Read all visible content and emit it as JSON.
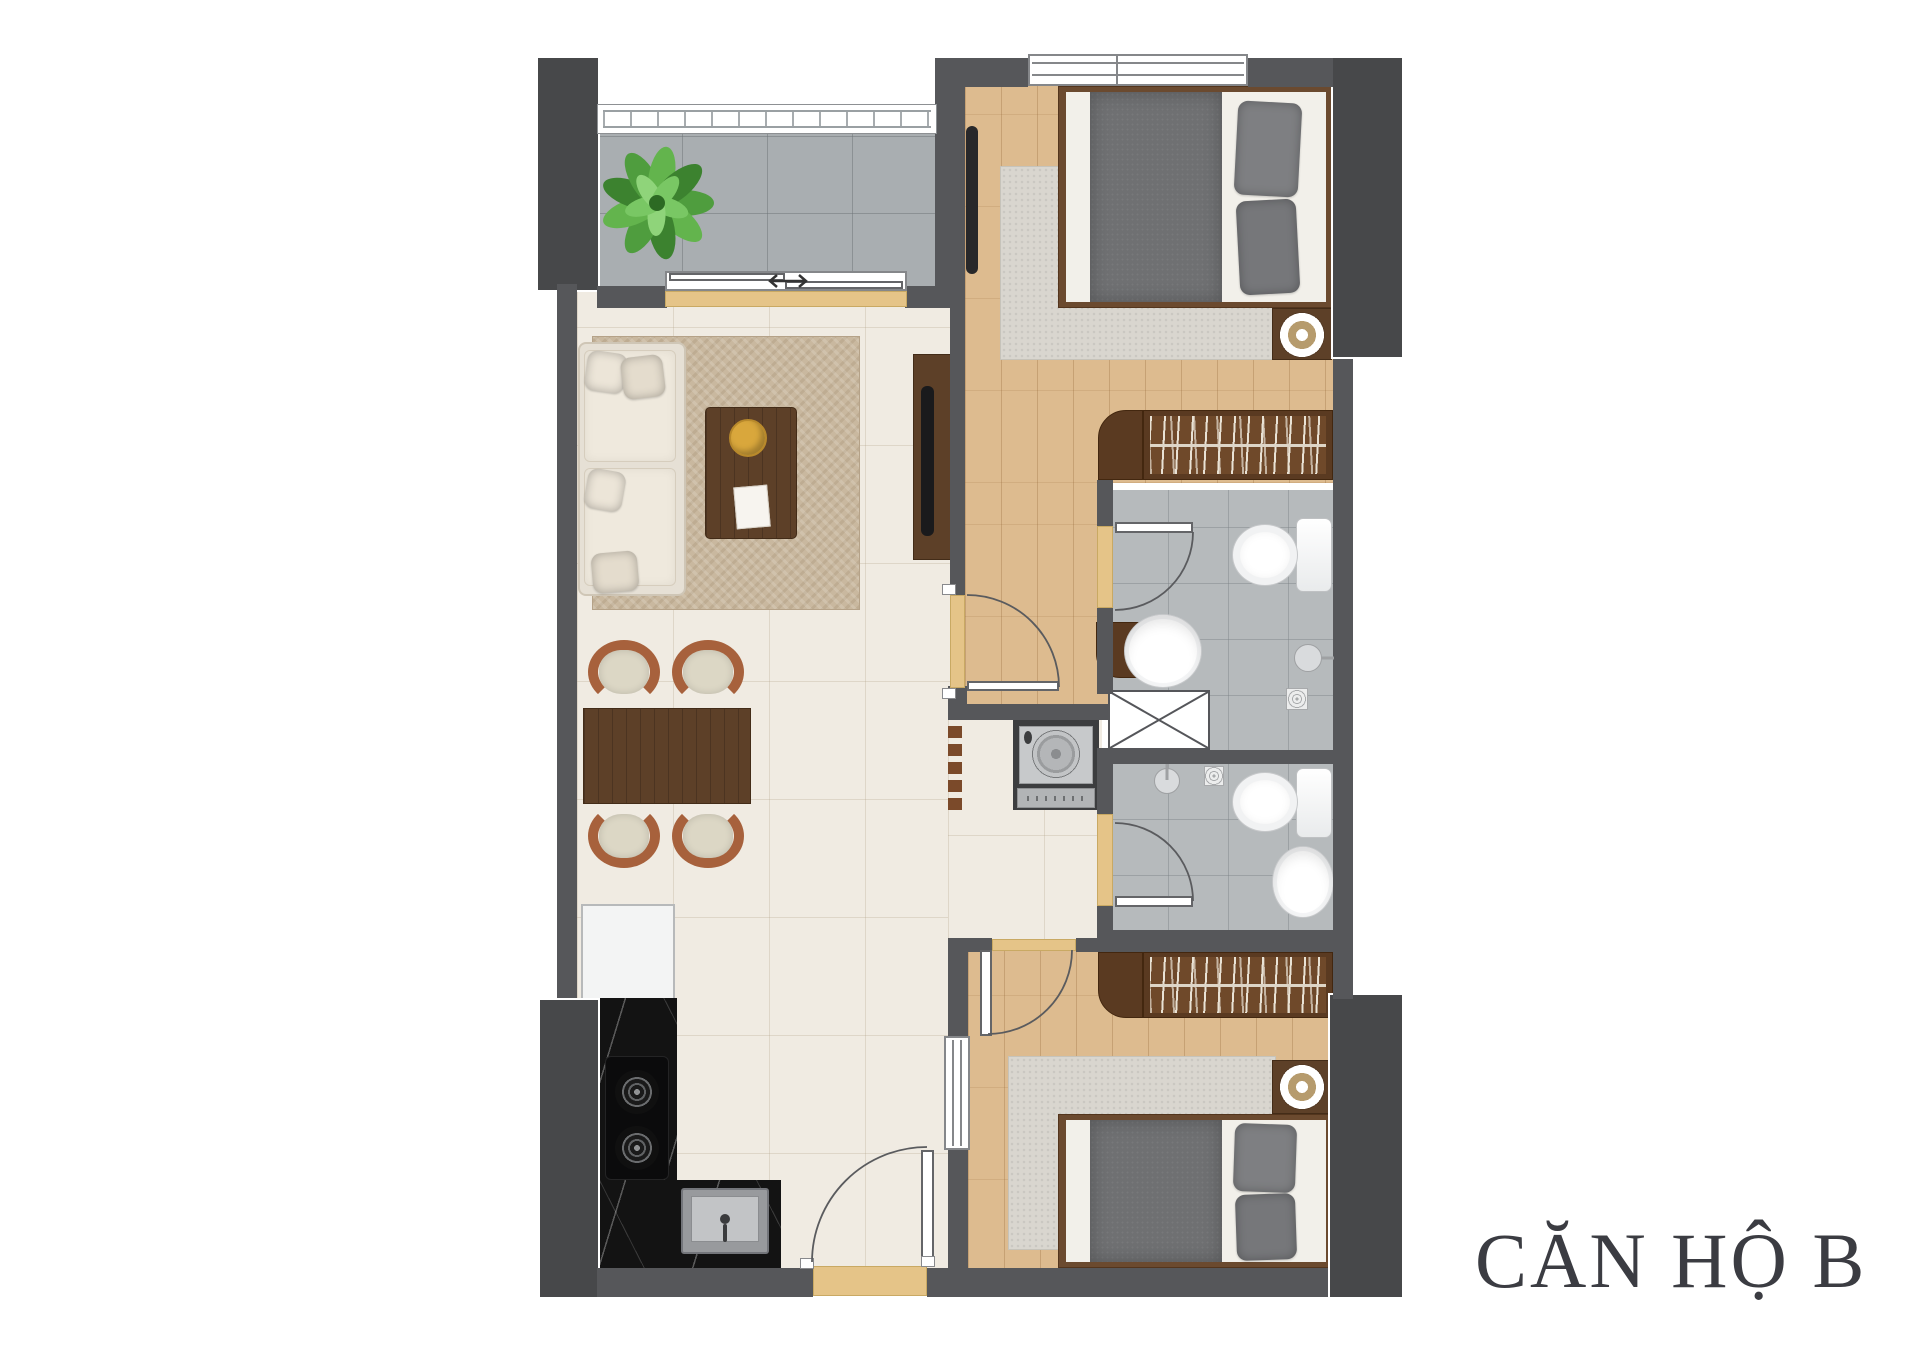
{
  "title": {
    "label": "CĂN HỘ B",
    "color": "#3b3c42"
  },
  "palette": {
    "background": "#ffffff",
    "wall": "#56575a",
    "pillar": "#47484a",
    "wood_floor": "#ddbb8f",
    "cream_floor": "#f0ebe2",
    "balcony_tile": "#a9aeb1",
    "bathroom_tile": "#b6babc",
    "threshold_accent": "#e5c488",
    "furniture_wood": "#5d4028",
    "wardrobe_wood": "#5a3a21",
    "sofa": "#e6e0d5",
    "living_rug": "#c9b89f",
    "bedroom_rug": "#d9d6cf",
    "bed_blanket": "#6f7072",
    "kitchen_counter": "#131313",
    "fixture_white": "#ffffff",
    "plant_green": "#55a243",
    "chair_frame": "#a7613c",
    "door_line": "#5a5b5e"
  },
  "plan": {
    "type": "apartment-floor-plan",
    "rooms": [
      {
        "id": "balcony",
        "items": [
          "potted-plant",
          "tile-floor",
          "railing",
          "sliding-door",
          "slide-arrow"
        ]
      },
      {
        "id": "living-room",
        "items": [
          "l-shaped-sofa",
          "throw-pillows",
          "coffee-table",
          "round-tray",
          "book",
          "area-rug",
          "tv-console",
          "tv"
        ]
      },
      {
        "id": "dining-area",
        "items": [
          "dining-table",
          "chair",
          "chair",
          "chair",
          "chair",
          "decor-partition"
        ]
      },
      {
        "id": "kitchen",
        "items": [
          "refrigerator",
          "marble-counter",
          "two-burner-cooktop",
          "kitchen-sink"
        ]
      },
      {
        "id": "hallway",
        "items": [
          "entrance-door",
          "washing-machine"
        ]
      },
      {
        "id": "bedroom-1",
        "items": [
          "double-bed",
          "pillows",
          "blanket",
          "rug",
          "nightstand",
          "lamp",
          "wall-tv",
          "wardrobe",
          "dresser",
          "window",
          "door"
        ]
      },
      {
        "id": "bathroom-1",
        "items": [
          "toilet",
          "wash-basin",
          "shower-head",
          "floor-drain",
          "door"
        ]
      },
      {
        "id": "technical-shaft",
        "items": [
          "shaft-x-box"
        ]
      },
      {
        "id": "bathroom-2",
        "items": [
          "toilet",
          "wash-basin",
          "shower-head",
          "floor-drain",
          "door"
        ]
      },
      {
        "id": "bedroom-2",
        "items": [
          "double-bed",
          "pillows",
          "blanket",
          "rug",
          "nightstand",
          "lamp",
          "wardrobe",
          "window",
          "door"
        ]
      }
    ]
  }
}
